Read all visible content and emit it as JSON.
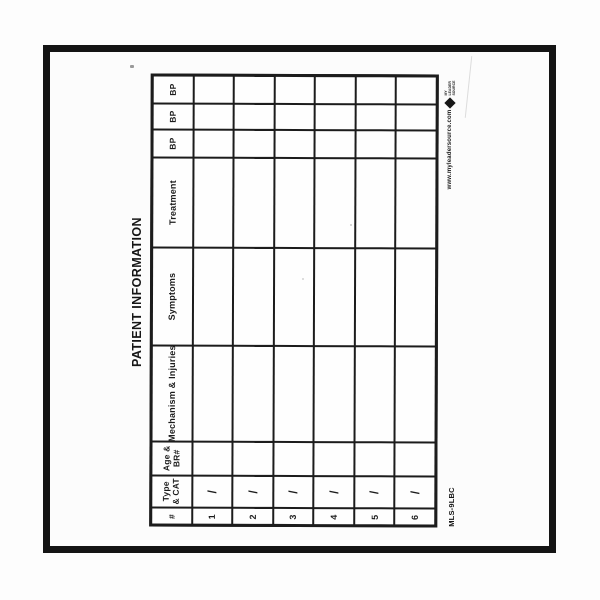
{
  "scan": {
    "title": "PATIENT INFORMATION",
    "form_code": "MLS-9LBC",
    "footer_website": "www.myleadersource.com",
    "logo": {
      "icon": "diamond-icon",
      "lines": [
        "MY",
        "LEADER",
        "SOURCE"
      ]
    },
    "table": {
      "headers": [
        {
          "label": "BP"
        },
        {
          "label": "BP"
        },
        {
          "label": "BP"
        },
        {
          "label": "Treatment"
        },
        {
          "label": "Symptoms"
        },
        {
          "label": "Mechanism & Injuries"
        },
        {
          "lines": [
            "Age &",
            "BR#"
          ]
        },
        {
          "lines": [
            "Type",
            "& CAT"
          ]
        },
        {
          "label": "#"
        }
      ],
      "rows": [
        {
          "num": "1",
          "type_cat": "/"
        },
        {
          "num": "2",
          "type_cat": "/"
        },
        {
          "num": "3",
          "type_cat": "/"
        },
        {
          "num": "4",
          "type_cat": "/"
        },
        {
          "num": "5",
          "type_cat": "/"
        },
        {
          "num": "6",
          "type_cat": "/"
        }
      ]
    }
  }
}
